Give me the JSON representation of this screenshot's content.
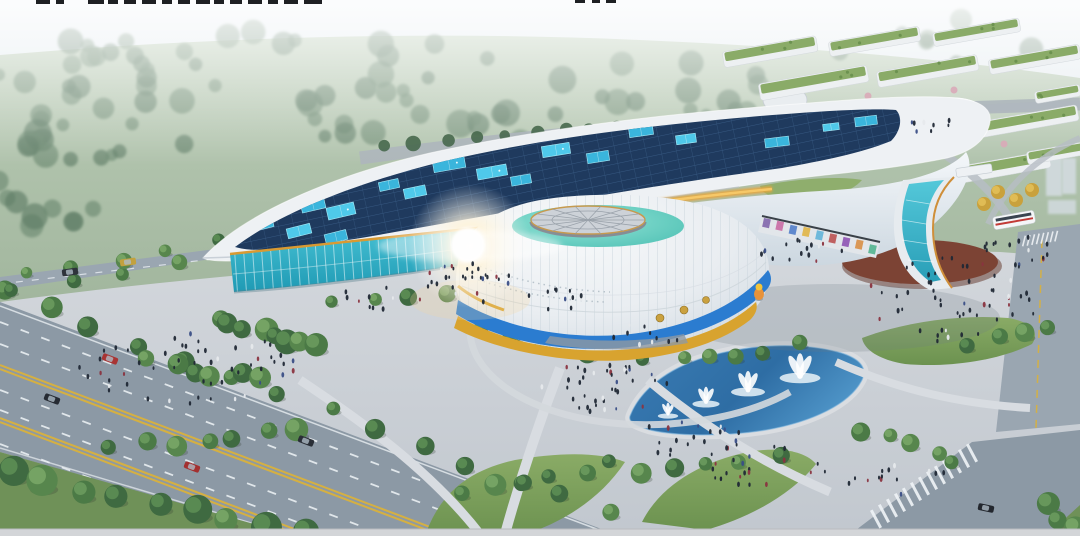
{
  "image": {
    "type": "architectural-aerial-rendering",
    "subject": "futuristic exhibition center with curved solar-panel roof, white dome hall with blue and gold bands, cantilevered wing on a glass pylon, plazas with crowds, fountain pool, tree-lined boulevard and campus with green roofs"
  },
  "palette": {
    "sky_top": "#e6edf2",
    "field": "#a9bda3",
    "road": "#8c99a5",
    "road_light": "#9aa6b1",
    "plaza": "#cbd0d6",
    "lane_white": "#e9eef2",
    "lane_yellow": "#d9b13c",
    "solar_dark": "#1f3a5e",
    "panel_cyan": "#4fc9ea",
    "roof_white": "#eef1f4",
    "gold": "#e2a33c",
    "glass_teal": "#35b9cd",
    "dome_white": "#e9edf1",
    "swoosh_blue": "#2b7cd0",
    "swoosh_gold": "#d8a32f",
    "ring_teal": "#66d2c6",
    "water": "#2e6da4",
    "grass": "#7fa35e",
    "tree_green": "#4b7a46",
    "red_oval": "#7c4334",
    "people_dark": "#202835",
    "bus_red": "#c23a36",
    "watermark": "#0b0d10",
    "bottom_bar": "#d3d5d8"
  },
  "scene": {
    "watermark_fragments": [
      [
        36,
        14
      ],
      [
        56,
        8
      ],
      [
        88,
        16
      ],
      [
        108,
        10
      ],
      [
        124,
        12
      ],
      [
        142,
        14
      ],
      [
        162,
        10
      ],
      [
        178,
        12
      ],
      [
        196,
        14
      ],
      [
        214,
        10
      ],
      [
        230,
        12
      ],
      [
        248,
        14
      ],
      [
        268,
        10
      ],
      [
        284,
        14
      ],
      [
        304,
        18
      ],
      [
        575,
        10
      ],
      [
        592,
        8
      ],
      [
        606,
        10
      ]
    ],
    "solar_panels": [
      [
        282,
        197,
        34,
        13,
        -13
      ],
      [
        313,
        205,
        24,
        11,
        -13
      ],
      [
        341,
        211,
        28,
        12,
        -13
      ],
      [
        259,
        224,
        28,
        12,
        -14
      ],
      [
        299,
        231,
        24,
        10,
        -14
      ],
      [
        336,
        237,
        22,
        10,
        -14
      ],
      [
        357,
        176,
        28,
        11,
        -12
      ],
      [
        389,
        185,
        20,
        9,
        -12
      ],
      [
        415,
        192,
        22,
        10,
        -12
      ],
      [
        449,
        164,
        32,
        12,
        -10
      ],
      [
        492,
        172,
        30,
        11,
        -10
      ],
      [
        521,
        180,
        20,
        9,
        -10
      ],
      [
        556,
        150,
        28,
        11,
        -9
      ],
      [
        598,
        157,
        22,
        10,
        -9
      ],
      [
        470,
        146,
        16,
        7,
        -10
      ],
      [
        641,
        131,
        24,
        10,
        -8
      ],
      [
        686,
        139,
        20,
        9,
        -8
      ],
      [
        624,
        119,
        16,
        7,
        -8
      ],
      [
        704,
        115,
        14,
        6,
        -8
      ],
      [
        777,
        142,
        24,
        9,
        -7
      ],
      [
        831,
        127,
        16,
        7,
        -7
      ],
      [
        866,
        121,
        22,
        9,
        -7
      ]
    ],
    "road_marks_white": [
      20,
      42,
      88,
      108,
      142
    ],
    "road_marks_yellow": [
      63,
      67,
      116,
      120
    ],
    "cars": [
      [
        110,
        359,
        21,
        "#a83434"
      ],
      [
        52,
        399,
        21,
        "#262b33"
      ],
      [
        192,
        467,
        21,
        "#a33030"
      ],
      [
        306,
        441,
        21,
        "#2a2f37"
      ],
      [
        70,
        272,
        -8,
        "#2e333b"
      ],
      [
        128,
        262,
        -8,
        "#c2a13e"
      ],
      [
        986,
        508,
        12,
        "#23272e"
      ]
    ],
    "bus": {
      "x": 1014,
      "y": 220,
      "w": 42,
      "h": 13,
      "r": -10
    },
    "fountains": [
      [
        668,
        414,
        12
      ],
      [
        706,
        402,
        16
      ],
      [
        748,
        390,
        20
      ],
      [
        800,
        376,
        24
      ]
    ],
    "tree_rows": [
      [
        0,
        290,
        610,
        516,
        14,
        9
      ],
      [
        10,
        472,
        300,
        534,
        9,
        13
      ],
      [
        215,
        318,
        320,
        345,
        8,
        10
      ],
      [
        150,
        362,
        258,
        380,
        6,
        9
      ],
      [
        115,
        448,
        300,
        432,
        7,
        10
      ],
      [
        335,
        300,
        445,
        292,
        4,
        8
      ],
      [
        482,
        332,
        592,
        352,
        5,
        8
      ],
      [
        648,
        362,
        800,
        346,
        6,
        8
      ],
      [
        862,
        428,
        958,
        458,
        5,
        9
      ],
      [
        462,
        492,
        612,
        466,
        6,
        9
      ],
      [
        648,
        474,
        775,
        452,
        5,
        9
      ],
      [
        1042,
        502,
        1075,
        530,
        3,
        11
      ],
      [
        965,
        345,
        1052,
        327,
        4,
        8
      ],
      [
        10,
        294,
        240,
        258,
        5,
        7
      ],
      [
        20,
        270,
        320,
        230,
        7,
        7
      ],
      [
        598,
        310,
        640,
        322,
        3,
        7
      ]
    ],
    "backroad_trees": [
      385,
      146,
      888,
      106,
      18
    ],
    "gold_trees": [
      [
        998,
        192
      ],
      [
        1016,
        200
      ],
      [
        1032,
        190
      ],
      [
        984,
        204
      ]
    ],
    "distant_tree_clusters": [
      [
        150,
        118,
        150,
        55,
        24
      ],
      [
        420,
        118,
        150,
        50,
        22
      ],
      [
        640,
        92,
        130,
        38,
        16
      ],
      [
        300,
        48,
        260,
        22,
        14
      ],
      [
        40,
        205,
        55,
        38,
        9
      ],
      [
        935,
        40,
        115,
        25,
        8
      ],
      [
        60,
        60,
        120,
        30,
        10
      ]
    ],
    "bg_buildings": [
      [
        722,
        52,
        95,
        16
      ],
      [
        828,
        42,
        92,
        15
      ],
      [
        932,
        33,
        88,
        14
      ],
      [
        758,
        84,
        110,
        17
      ],
      [
        876,
        72,
        102,
        16
      ],
      [
        988,
        60,
        92,
        15
      ],
      [
        842,
        110,
        64,
        13
      ],
      [
        1034,
        92,
        46,
        12
      ],
      [
        978,
        122,
        100,
        16
      ],
      [
        876,
        134,
        92,
        15
      ],
      [
        938,
        170,
        112,
        17
      ],
      [
        1026,
        152,
        64,
        13
      ]
    ],
    "blossom_trees": [
      [
        868,
        96
      ],
      [
        914,
        126
      ],
      [
        1004,
        144
      ],
      [
        954,
        90
      ],
      [
        884,
        160
      ]
    ],
    "people_clusters": [
      [
        190,
        368,
        112,
        36,
        55
      ],
      [
        468,
        283,
        46,
        20,
        30
      ],
      [
        600,
        388,
        72,
        24,
        38
      ],
      [
        688,
        438,
        58,
        18,
        22
      ],
      [
        950,
        300,
        88,
        44,
        52
      ],
      [
        1012,
        252,
        48,
        16,
        18
      ],
      [
        762,
        466,
        68,
        20,
        22
      ],
      [
        800,
        251,
        46,
        11,
        16
      ],
      [
        895,
        478,
        55,
        18,
        14
      ],
      [
        934,
        127,
        28,
        9,
        8
      ],
      [
        556,
        300,
        30,
        12,
        12
      ],
      [
        378,
        300,
        42,
        14,
        10
      ],
      [
        648,
        335,
        36,
        12,
        10
      ]
    ],
    "mural_tile_colors": [
      "#7b5ea8",
      "#c864a0",
      "#4a78c8",
      "#e0b23c",
      "#5ab0d8",
      "#b84848",
      "#8a4ab0",
      "#d88a3c",
      "#4ab08a"
    ]
  }
}
